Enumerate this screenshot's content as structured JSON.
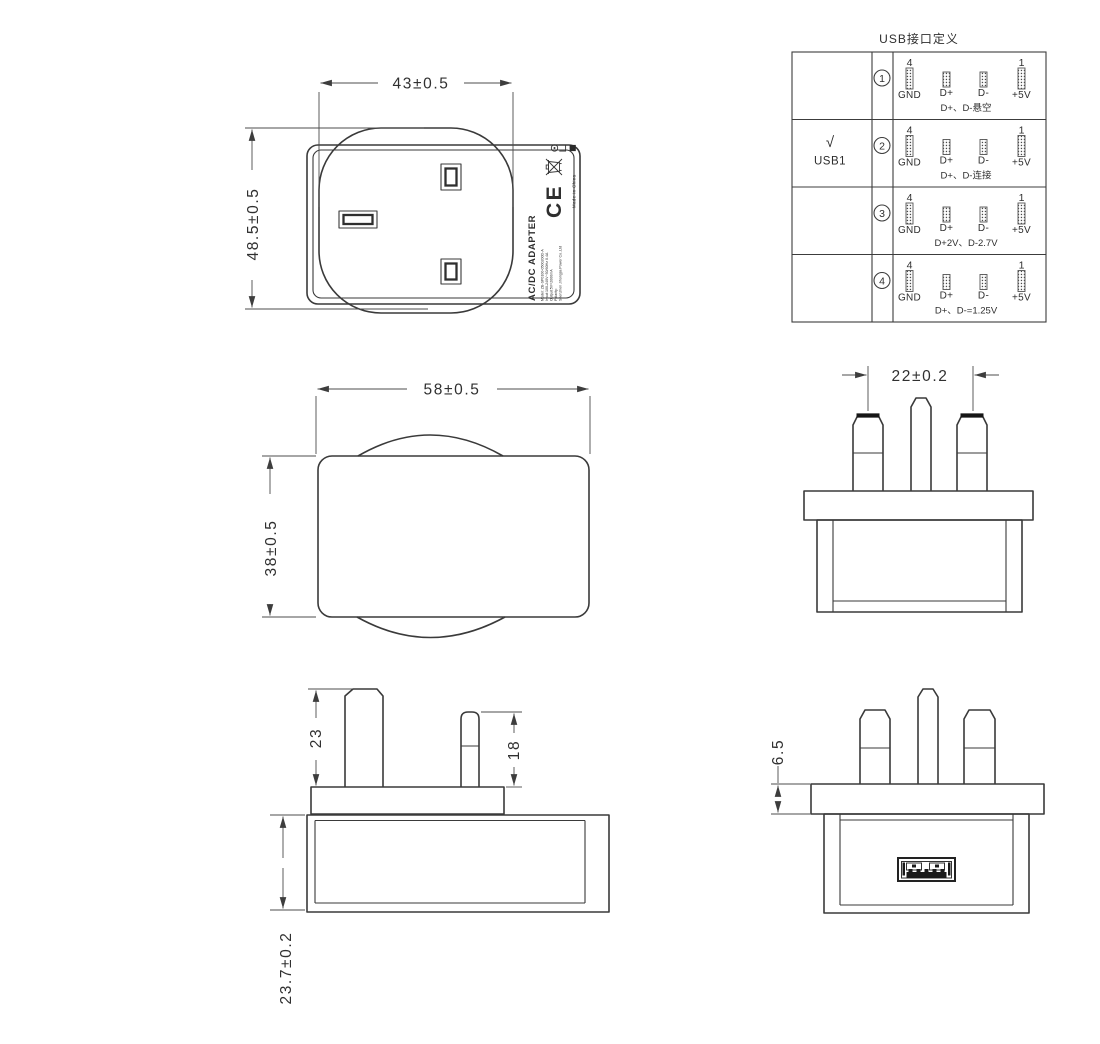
{
  "usb_table": {
    "title": "USB接口定义",
    "pin_index_left": "4",
    "pin_index_right": "1",
    "pin_labels": [
      "GND",
      "D+",
      "D-",
      "+5V"
    ],
    "rows": [
      {
        "num": "1",
        "note": "D+、D-悬空",
        "check": "",
        "port": ""
      },
      {
        "num": "2",
        "note": "D+、D-连接",
        "check": "√",
        "port": "USB1"
      },
      {
        "num": "3",
        "note": "D+2V、D-2.7V",
        "check": "",
        "port": ""
      },
      {
        "num": "4",
        "note": "D+、D-=1.25V",
        "check": "",
        "port": ""
      }
    ]
  },
  "dimensions": {
    "front_width": "43±0.5",
    "front_height": "48.5±0.5",
    "top_width": "58±0.5",
    "top_depth": "38±0.5",
    "pin_spacing": "22±0.2",
    "earth_pin_length": "23",
    "power_pin_length": "18",
    "body_thickness": "23.7±0.2",
    "flange_thickness": "6.5"
  },
  "adapter_label": {
    "title": "AC/DC ADAPTER",
    "line_model": "Model: ZB-SP0100-0500200D-A",
    "line_input": "Input:100-240V~50/60Hz 0.4A",
    "line_output": "Output:5V=2000mA",
    "line_polarity": "Polarity:",
    "line_company": "Shenzhen Jihongjia Power Co.,Ltd",
    "ce_mark": "CE",
    "made_in": "Made in China"
  }
}
